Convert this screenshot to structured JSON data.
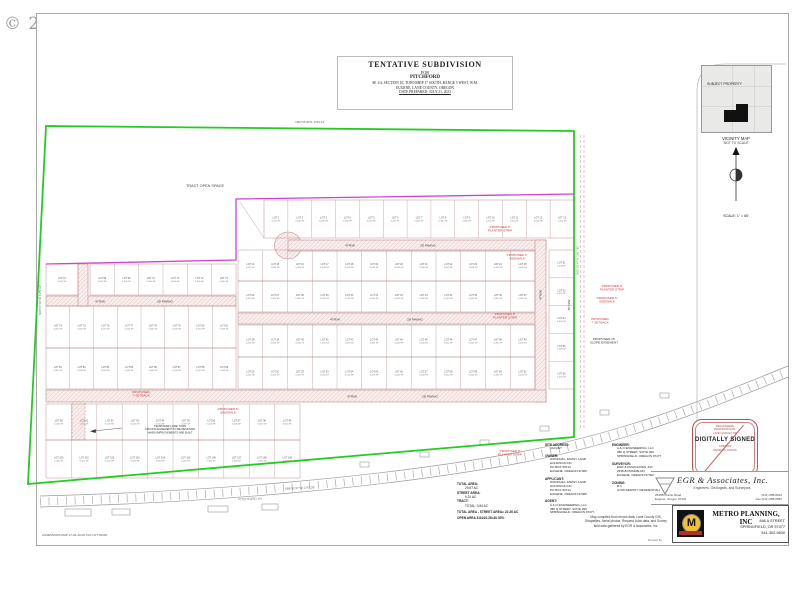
{
  "watermark": "© 2023",
  "title_block": {
    "line1": "TENTATIVE SUBDIVISION",
    "line2": "FOR",
    "line3": "PITCHFORD",
    "line4": "SE 1/4, SECTION 10, TOWNSHIP 17 SOUTH, RANGE 5 WEST, W.M.",
    "line5": "EUGENE, LANE COUNTY, OREGON",
    "line6": "DATE PREPARED: JULY 21, 2023"
  },
  "vicinity": {
    "subject_label": "SUBJECT PROPERTY",
    "caption1": "VICINITY MAP",
    "caption2": "NOT TO SCALE",
    "scale": "SCALE: 1\" = 60'"
  },
  "stamp": {
    "top1": "REGISTERED",
    "top2": "PROFESSIONAL",
    "top3": "LAND SURVEYOR",
    "middle": "DIGITALLY SIGNED",
    "bottom1": "OREGON",
    "bottom2": "RENEWS: 6/30/25"
  },
  "egr": {
    "name": "EGR  &  Associates,  Inc.",
    "tagline": "Engineers, Geologists, and Surveyors",
    "addr1": "2535B Prairie Road",
    "addr2": "Eugene, Oregon 97402",
    "phone": "(541) 688-8322",
    "fax": "Fax (541) 688-8087"
  },
  "metro": {
    "logo_letter": "M",
    "name": "METRO PLANNING, INC",
    "addr1": "846 A STREET",
    "addr2": "SPRINGFIELD, OR 97477",
    "phone": "541-302-9830"
  },
  "notes": {
    "site_address": {
      "label": "SITE ADDRESS:",
      "l0": "VACANT"
    },
    "owner": {
      "label": "OWNER:",
      "l0": "WOODHILL FAMILY LAND",
      "l1": "HOLDINGS INC",
      "l2": "PO BOX 50714",
      "l3": "EUGENE, OREGON 97405"
    },
    "applicant": {
      "label": "APPLICANT:",
      "l0": "WOODHILL FAMILY LAND",
      "l1": "HOLDINGS INC",
      "l2": "PO BOX 50714",
      "l3": "EUGENE, OREGON 97405"
    },
    "agent": {
      "label": "AGENT:",
      "l0": "A & O ENGINEERING, LLC",
      "l1": "380 Q STREET, SUITE 200",
      "l2": "SPRINGFIELD, OREGON  97477"
    },
    "engineer": {
      "label": "ENGINEER:",
      "l0": "A & O ENGINEERING, LLC",
      "l1": "380 Q STREET, SUITE 200",
      "l2": "SPRINGFIELD, OREGON  97477"
    },
    "surveyor": {
      "label": "SURVEYOR:",
      "l0": "EGR & ASSOCIATES, INC",
      "l1": "2535-B PRAIRIE RD",
      "l2": "EUGENE, OREGON 97402"
    },
    "zoning": {
      "label": "ZONING:",
      "l0": "R-1",
      "l1": "(LOW DENSITY RESIDENTIAL)"
    }
  },
  "areas": {
    "a1_label": "TOTAL AREA:",
    "a1_value": "29.67 AC",
    "a2_label": "STREET AREA:",
    "a2_value": "6.31 AC",
    "a3_label": "TRACT:",
    "a3_value": "TOTAL: 0.84 AC",
    "sum1": "TOTAL AREA - STREET AREA= 22.26 AC",
    "sum2": "OPEN AREA 8.84/22.26=40.50%"
  },
  "map_note": {
    "l0": "Map compiled from record data, Lane County GIS,",
    "l1": "Shapefiles, Aerial photos, Request Lidar data, and Survey",
    "l2": "field data gathered by EGR & Associates, Inc."
  },
  "assessor": "ASSESSORS MAP 17-04-10-00  TAX LOT 00100",
  "revised": "Revised By",
  "plat": {
    "boundary_color": "#22cc22",
    "interior_boundary_color": "#cc44cc",
    "lot_line_color": "#b08a84",
    "street_edge_color": "#c08a8a",
    "red_label_color": "#cc3333",
    "lot_prefix": "LOT",
    "lot_area": "5,000 SF",
    "open_space_label": "TRACT OPEN SPACE",
    "rows": [
      {
        "x0": 264,
        "x1": 574,
        "y0": 200,
        "y1": 238,
        "n": 13,
        "start": 1
      },
      {
        "x0": 238,
        "x1": 535,
        "y0": 250,
        "y1": 281,
        "n": 12,
        "start": 14
      },
      {
        "x0": 238,
        "x1": 535,
        "y0": 281,
        "y1": 312,
        "n": 12,
        "start": 26
      },
      {
        "x0": 238,
        "x1": 535,
        "y0": 325,
        "y1": 357,
        "n": 12,
        "start": 38
      },
      {
        "x0": 238,
        "x1": 535,
        "y0": 357,
        "y1": 389,
        "n": 12,
        "start": 50
      },
      {
        "x0": 549,
        "x1": 574,
        "y0": 250,
        "y1": 389,
        "n": 5,
        "start": 62,
        "vert": true
      },
      {
        "x0": 46,
        "x1": 78,
        "y0": 264,
        "y1": 295,
        "n": 1,
        "start": 67
      },
      {
        "x0": 90,
        "x1": 236,
        "y0": 264,
        "y1": 295,
        "n": 6,
        "start": 68
      },
      {
        "x0": 46,
        "x1": 236,
        "y0": 306,
        "y1": 348,
        "n": 8,
        "start": 74
      },
      {
        "x0": 46,
        "x1": 236,
        "y0": 348,
        "y1": 389,
        "n": 8,
        "start": 82
      },
      {
        "x0": 46,
        "x1": 300,
        "y0": 404,
        "y1": 440,
        "n": 10,
        "start": 90
      },
      {
        "x0": 46,
        "x1": 300,
        "y0": 440,
        "y1": 478,
        "n": 10,
        "start": 100
      }
    ],
    "annotations": [
      {
        "x": 205,
        "y": 187,
        "size": 3.8,
        "color": "#444",
        "lines": [
          "TRACT OPEN SPACE"
        ]
      },
      {
        "x": 350,
        "y": 246.5,
        "size": 3,
        "color": "#333",
        "lines": [
          "47'R/W"
        ]
      },
      {
        "x": 428,
        "y": 246.5,
        "size": 3,
        "color": "#333",
        "lines": [
          "28' PAVING"
        ]
      },
      {
        "x": 335,
        "y": 320.5,
        "size": 3,
        "color": "#333",
        "lines": [
          "47'R/W"
        ]
      },
      {
        "x": 415,
        "y": 320.5,
        "size": 3,
        "color": "#333",
        "lines": [
          "28' PAVING"
        ]
      },
      {
        "x": 100,
        "y": 302.5,
        "size": 3,
        "color": "#333",
        "lines": [
          "47'R/W"
        ]
      },
      {
        "x": 165,
        "y": 302.5,
        "size": 3,
        "color": "#333",
        "lines": [
          "28' PAVING"
        ]
      },
      {
        "x": 352,
        "y": 397.5,
        "size": 3,
        "color": "#333",
        "lines": [
          "47'R/W"
        ]
      },
      {
        "x": 430,
        "y": 397.5,
        "size": 3,
        "color": "#333",
        "lines": [
          "28' PAVING"
        ]
      },
      {
        "x": 541.5,
        "y": 295,
        "size": 3,
        "color": "#333",
        "rot": -90,
        "lines": [
          "47'R/W"
        ]
      },
      {
        "x": 500,
        "y": 228,
        "size": 3.1,
        "color": "#cc3333",
        "lines": [
          "PROPOSED 8'",
          "PLANTER STRIP"
        ]
      },
      {
        "x": 517,
        "y": 256,
        "size": 3.1,
        "color": "#cc3333",
        "lines": [
          "PROPOSED 5'",
          "SIDEWALK"
        ]
      },
      {
        "x": 505,
        "y": 315,
        "size": 3.1,
        "color": "#cc3333",
        "lines": [
          "PROPOSED 8'",
          "PLANTER STRIP"
        ]
      },
      {
        "x": 612,
        "y": 287,
        "size": 3.1,
        "color": "#cc3333",
        "lines": [
          "PROPOSED 8'",
          "PLANTER STRIP"
        ]
      },
      {
        "x": 607,
        "y": 299,
        "size": 3.1,
        "color": "#cc3333",
        "lines": [
          "PROPOSED 5'",
          "SIDEWALK"
        ]
      },
      {
        "x": 600,
        "y": 320,
        "size": 3.1,
        "color": "#cc3333",
        "lines": [
          "PROPOSED",
          "7' SETBACK"
        ]
      },
      {
        "x": 604,
        "y": 340,
        "size": 3.1,
        "color": "#333",
        "lines": [
          "PROPOSED 15'",
          "SLOPE EASEMENT"
        ]
      },
      {
        "x": 141,
        "y": 393,
        "size": 3.1,
        "color": "#cc3333",
        "lines": [
          "PROPOSED",
          "7' SETBACK"
        ]
      },
      {
        "x": 228,
        "y": 410,
        "size": 3.1,
        "color": "#cc3333",
        "lines": [
          "PROPOSED 5'",
          "SIDEWALK"
        ]
      },
      {
        "x": 510,
        "y": 452,
        "size": 3.1,
        "color": "#cc3333",
        "lines": [
          "PROPOSED 8'",
          "PLANTER STRIP"
        ]
      },
      {
        "x": 170,
        "y": 427,
        "size": 2.7,
        "color": "#333",
        "lines": [
          "TEMPORARY FIRE TURN",
          "AROUND EASEMENT TO BE REMOVED",
          "WHEN IMPROVEMENTS ARE BUILT"
        ]
      },
      {
        "x": 310,
        "y": 123,
        "size": 3,
        "color": "#666",
        "lines": [
          "N89°54'40\"E  1739.13'"
        ]
      },
      {
        "x": 41,
        "y": 300,
        "size": 3,
        "color": "#666",
        "rot": -90,
        "lines": [
          "N00°07'19\"W  1175.33'"
        ]
      },
      {
        "x": 578.5,
        "y": 260,
        "size": 3,
        "color": "#666",
        "rot": -90,
        "lines": [
          "S00°03'47\"E  1007.86'"
        ]
      },
      {
        "x": 300,
        "y": 489,
        "size": 3,
        "color": "#666",
        "rot": -3,
        "lines": [
          "S89°52'47\"W  1747.35'"
        ]
      },
      {
        "x": 570,
        "y": 305,
        "size": 3,
        "color": "#333",
        "rot": -90,
        "lines": [
          "56' R/W"
        ]
      },
      {
        "x": 250,
        "y": 500,
        "size": 3.2,
        "color": "#777",
        "rot": -2,
        "lines": [
          "PITCHFORD LN"
        ]
      }
    ]
  }
}
